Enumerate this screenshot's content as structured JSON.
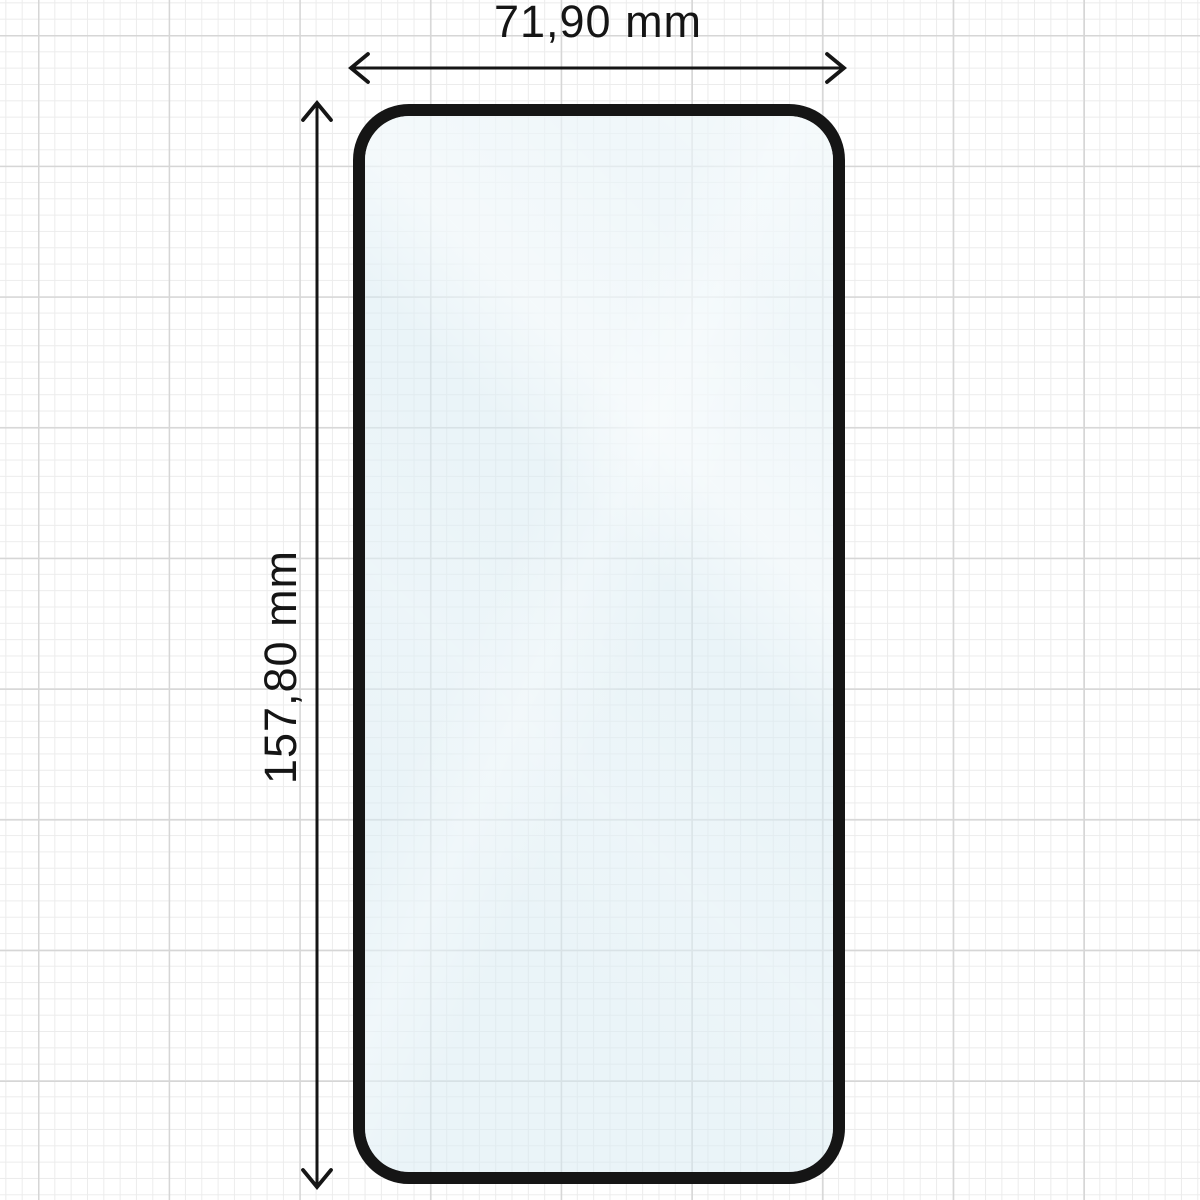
{
  "diagram": {
    "width_label": "71,90 mm",
    "height_label": "157,80 mm"
  },
  "icons": {
    "horizontal_arrow": "double-headed-arrow-left-right",
    "vertical_arrow": "double-headed-arrow-up-down"
  },
  "colors": {
    "line": "#151515",
    "grid_minor": "#ececec",
    "grid_major": "#d6d6d6",
    "glass_tint": "#d9ebf3",
    "bg": "#ffffff"
  }
}
